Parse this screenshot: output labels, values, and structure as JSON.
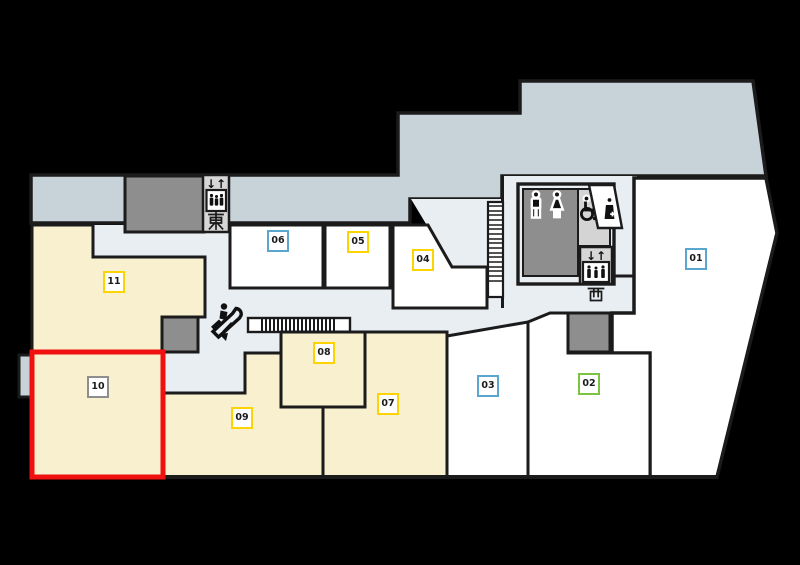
{
  "floor_map": {
    "floor_shape": "mall-floor-plan",
    "units": [
      {
        "number": "01",
        "category": "vacant-white",
        "label_border_color": "#5ba6cf"
      },
      {
        "number": "02",
        "category": "vacant-white",
        "label_border_color": "#7cc243"
      },
      {
        "number": "03",
        "category": "vacant-white",
        "label_border_color": "#5ba6cf"
      },
      {
        "number": "04",
        "category": "vacant-white",
        "label_border_color": "#fcd303"
      },
      {
        "number": "05",
        "category": "vacant-white",
        "label_border_color": "#fcd303"
      },
      {
        "number": "06",
        "category": "vacant-white",
        "label_border_color": "#5ba6cf"
      },
      {
        "number": "07",
        "category": "tenant-yellow",
        "label_border_color": "#fcd303"
      },
      {
        "number": "08",
        "category": "tenant-yellow",
        "label_border_color": "#fcd303"
      },
      {
        "number": "09",
        "category": "tenant-yellow",
        "label_border_color": "#fcd303"
      },
      {
        "number": "10",
        "category": "tenant-yellow-highlighted",
        "label_border_color": "#8e8e8e"
      },
      {
        "number": "11",
        "category": "tenant-yellow",
        "label_border_color": "#fcd303"
      }
    ],
    "highlight": {
      "unit": "10",
      "outline_color": "#f01010"
    },
    "facilities": {
      "elevator_east": {
        "label": "東",
        "arrows": "↓↑"
      },
      "elevator_west": {
        "label": "西",
        "arrows": "↓↑"
      },
      "restroom": {
        "icons": [
          "mens-restroom",
          "womens-restroom",
          "wheelchair-accessible",
          "nursing-room"
        ]
      },
      "escalator": {
        "direction": "down"
      },
      "stairs": {
        "present": "yes"
      },
      "moving_walkway": {
        "present": "yes"
      }
    },
    "colors": {
      "deck_blue_gray": "#c8d2d9",
      "corridor": "#e9eef3",
      "unit_yellow": "#f9f0d0",
      "unit_white": "#ffffff",
      "block_gray": "#8e8e8e",
      "elevator_gray": "#d6d6d6",
      "wall": "#1b1b1b",
      "highlight_red": "#f01010"
    }
  }
}
